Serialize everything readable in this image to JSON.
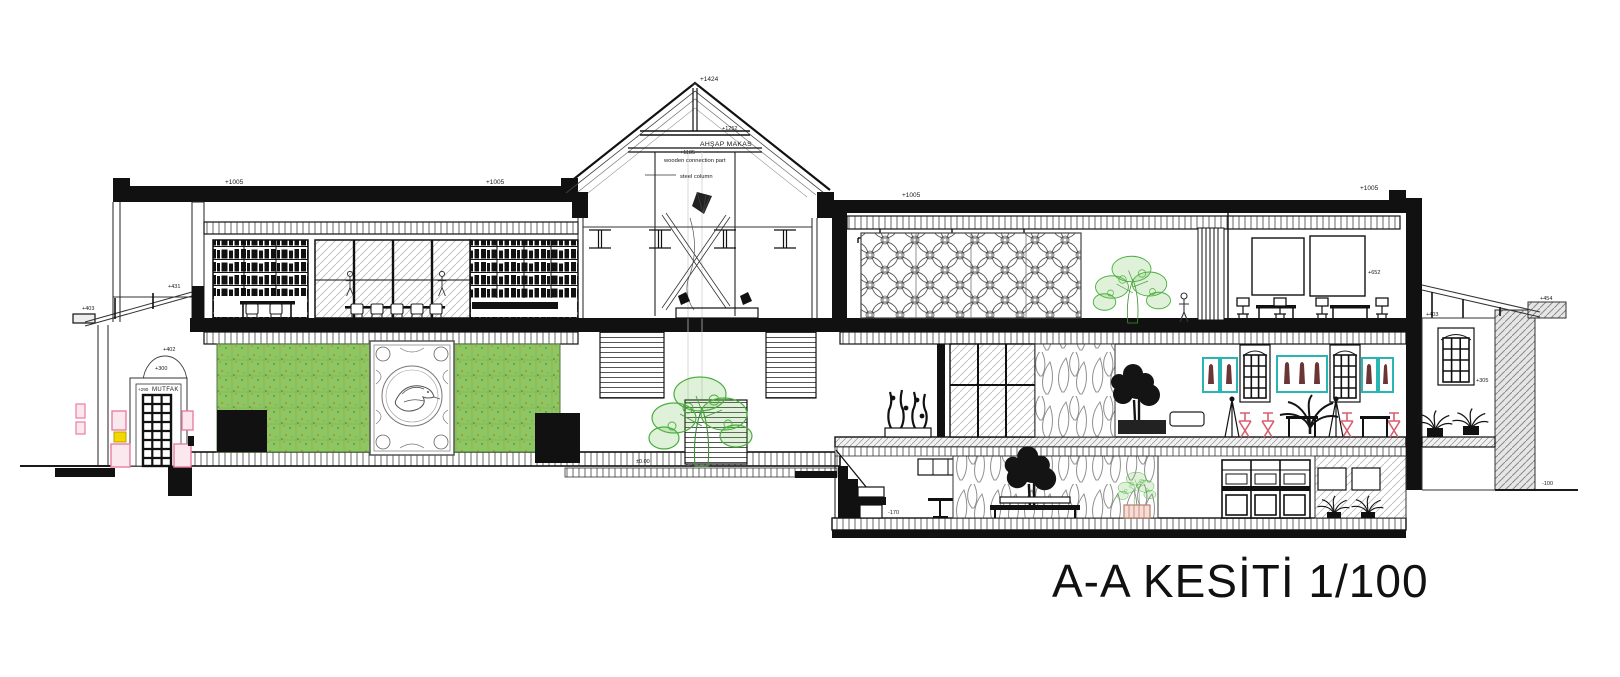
{
  "title": "A-A KESİTİ 1/100",
  "annotations": {
    "apex": "+1424",
    "tie_upper": "+1252",
    "truss_label": "AHŞAP MAKAS",
    "tie_lower": "+1185",
    "wooden_part": "wooden connection part",
    "steel_column": "steel column",
    "roof_left_a": "+1005",
    "roof_left_b": "+1005",
    "roof_right_a": "+1005",
    "roof_right_b": "+1005",
    "wall_upper": "+431",
    "wall_lower": "+402",
    "annex_cap": "+403",
    "arch_top": "+300",
    "door_level": "+290",
    "door_label": "MUTFAK",
    "ground_level": "±0.00",
    "canopy_eave": "+652",
    "end_room_ceiling": "+403",
    "window_sill": "+305",
    "canopy_cap": "+454",
    "ground_right": "-100",
    "basement_floor": "-170",
    "basement_foundation": "-308"
  },
  "colors": {
    "line": "#1a1a1a",
    "vegetation_green": "#4aaf3e",
    "living_wall_green": "#8cc763",
    "living_wall_accent": "#b5a437",
    "pink": "#e87fa0",
    "yellow": "#f2d800",
    "cyan": "#2ab5b5",
    "red_chair": "#d95f6f",
    "hatch_gray": "#9a9a9a"
  }
}
